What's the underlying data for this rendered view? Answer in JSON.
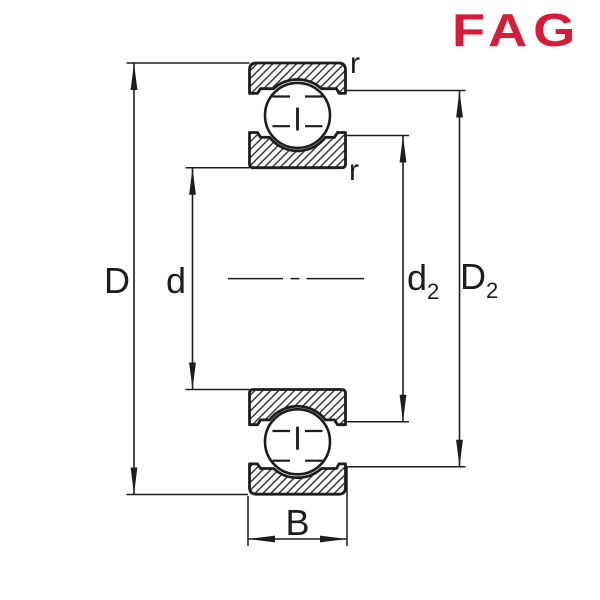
{
  "logo": {
    "text": "FAG",
    "color": "#d81b38"
  },
  "drawing": {
    "type": "bearing-cross-section-dimension-drawing",
    "description": "Deep groove ball bearing cross section with dimension lines",
    "colors": {
      "line": "#1d1d1b",
      "background": "#ffffff"
    },
    "dimension_labels": {
      "outer_diameter": "D",
      "bore_diameter": "d",
      "inner_recess_main": "d",
      "inner_recess_sub": "2",
      "outer_recess_main": "D",
      "outer_recess_sub": "2",
      "width": "B",
      "chamfer_top": "r",
      "chamfer_bottom": "r"
    }
  }
}
